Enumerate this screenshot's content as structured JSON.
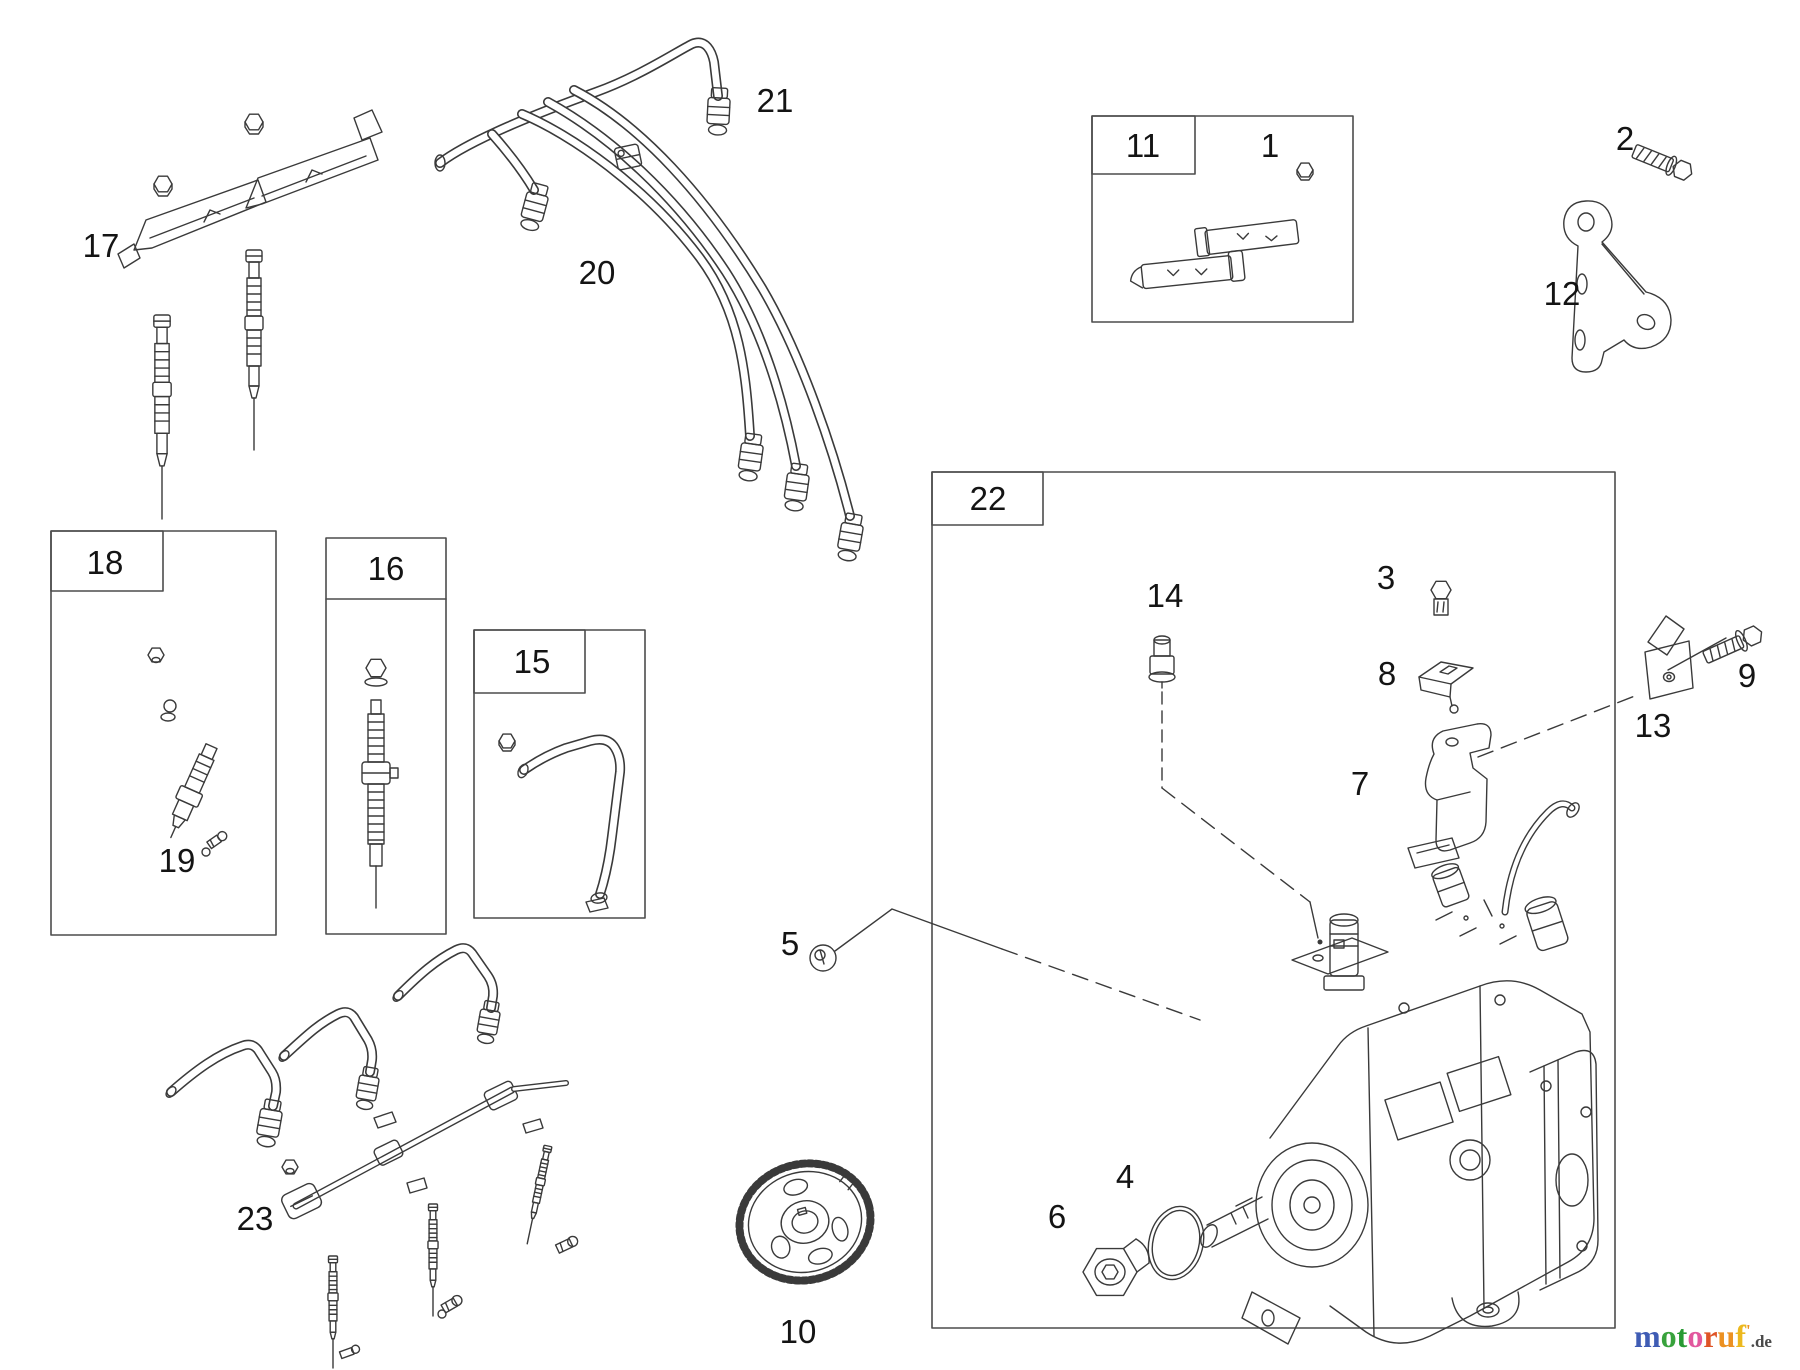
{
  "canvas": {
    "background": "#ffffff",
    "line_color": "#3a3a3a",
    "label_color": "#141414"
  },
  "callouts": [
    {
      "n": "1",
      "x": 1270,
      "y": 157
    },
    {
      "n": "2",
      "x": 1625,
      "y": 150
    },
    {
      "n": "3",
      "x": 1386,
      "y": 589
    },
    {
      "n": "4",
      "x": 1125,
      "y": 1188
    },
    {
      "n": "5",
      "x": 790,
      "y": 955
    },
    {
      "n": "6",
      "x": 1057,
      "y": 1228
    },
    {
      "n": "7",
      "x": 1360,
      "y": 795
    },
    {
      "n": "8",
      "x": 1387,
      "y": 685
    },
    {
      "n": "9",
      "x": 1747,
      "y": 687
    },
    {
      "n": "10",
      "x": 798,
      "y": 1343
    },
    {
      "n": "11",
      "x": 1143,
      "y": 157
    },
    {
      "n": "12",
      "x": 1562,
      "y": 305
    },
    {
      "n": "13",
      "x": 1653,
      "y": 737
    },
    {
      "n": "14",
      "x": 1165,
      "y": 607
    },
    {
      "n": "15",
      "x": 532,
      "y": 673
    },
    {
      "n": "16",
      "x": 386,
      "y": 580
    },
    {
      "n": "17",
      "x": 101,
      "y": 257
    },
    {
      "n": "18",
      "x": 105,
      "y": 574
    },
    {
      "n": "19",
      "x": 177,
      "y": 872
    },
    {
      "n": "20",
      "x": 597,
      "y": 284
    },
    {
      "n": "21",
      "x": 775,
      "y": 112
    },
    {
      "n": "22",
      "x": 988,
      "y": 510
    },
    {
      "n": "23",
      "x": 255,
      "y": 1230
    }
  ],
  "logo": {
    "letters": [
      {
        "ch": "m",
        "color": "#3f5cb4"
      },
      {
        "ch": "o",
        "color": "#38a23c"
      },
      {
        "ch": "t",
        "color": "#279a33"
      },
      {
        "ch": "o",
        "color": "#e2579e"
      },
      {
        "ch": "r",
        "color": "#df5426"
      },
      {
        "ch": "u",
        "color": "#ec9122"
      },
      {
        "ch": "f",
        "color": "#ecb81e"
      }
    ],
    "tick": "'",
    "tick_color": "#ec9122",
    "suffix": ".de",
    "suffix_color": "#4a4a4a"
  }
}
